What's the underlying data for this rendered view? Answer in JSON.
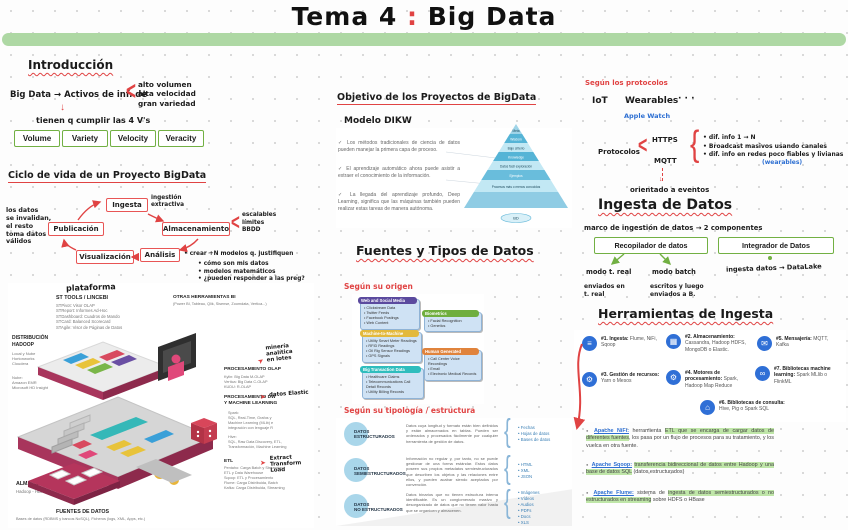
{
  "title": {
    "left": "Tema 4",
    "colon": ":",
    "right": "Big Data"
  },
  "icons": {
    "angle": "<",
    "curly": "{",
    "arrow_down": "↓",
    "check": "✓",
    "hand_arrow": "➤",
    "dot": "●"
  },
  "intro": {
    "heading": "Introducción",
    "definition": "Big Data → Activos de inf. de",
    "brace_items": "alto volumen\nalta velocidad\ngran variedad",
    "subline": "tienen q cumplir las 4 V's",
    "vs": [
      "Volume",
      "Variety",
      "Velocity",
      "Veracity"
    ]
  },
  "ciclo": {
    "heading": "Ciclo de vida de un Proyecto BigData",
    "left_note": "los datos\nse invalidan,\nel resto\ntoma datos\nválidos",
    "ingesta": "Ingesta",
    "ingesta_note": "ingestión\nextractiva",
    "almacenamiento": "Almacenamiento",
    "almacenamiento_notes": "escalables\nlímites\nBBDD",
    "analisis": "Análisis",
    "analisis_note": "• crear +N modelos q. justifiquen",
    "analisis_bullets": "• cómo son mis datos\n• modelos matemáticos\n• ¿pueden responder a las preg?",
    "visualizacion": "Visualización",
    "publicacion": "Publicación"
  },
  "iso": {
    "handwritten_title": "plataforma",
    "sttools_title": "ST TOOLS / LINCEBI",
    "sttools_items": "STPivot: Visor OLAP\nSTReport: Informes Ad-Hoc\nSTDashboard: Cuadros de Mando\nSTCard: Balanced Scorecard\nSTAgile: Visor de Páginas de Datos",
    "otras_title": "OTRAS HERRAMIENTAS BI",
    "otras_items": "(Power BI, Tableau, Qlik, Sisense, Zoomdata, Vertica...)",
    "distrib_title": "DISTRIBUCIÓN\nHADOOP",
    "distrib_local": "Local y Nube\nHortonworks\nCloudera",
    "distrib_nube": "Nube:\nAmazon EMR\nMicrosoft HD Insight",
    "olap_title": "PROCESAMIENTO OLAP",
    "olap_items": "Kylin: Big Data M-OLAP\nVertica: Big Data C-OLAP\nKUDU: R-OLAP",
    "olap_note": "minería analítica\nen lotes",
    "dw_title": "PROCESAMIENTO DW\nY MACHINE LEARNING",
    "dw_note": "datos Elastic",
    "spark": "Spark:\nSQL, Real-Time, Grafos y\nMachine Learning (MLib) e\nintegración con lenguaje R",
    "hive": "Hive:\nSQL, Raw Data Discovery, ETL,\nTransformación, Machine Learning",
    "etl_title": "ETL",
    "etl_items": "Pentaho: Carga Batch y Streaming,\nETL y Data Warehouse\nSqoop: ETL y Procesamiento\nFlume: Carga Distribuida, Batch\nKafka: Carga Distribuida, Streaming",
    "etl_note": "Extract\nTransform\nLoad",
    "alm_title": "ALMACENAMIENTO DISTRIBUIDO",
    "alm_items": "Hadoop - HDFS        Amazon S3",
    "fuentes_title": "FUENTES DE DATOS",
    "fuentes_items": "Bases de datos (RDBMS y bancos NoSQL), Ficheros (logs, XML, Apps, etc.)"
  },
  "objetivo": {
    "heading": "Objetivo de los Proyectos de BigData",
    "modelo": "Modelo DIKW",
    "bullets": [
      "Los métodos tradicionales de ciencia de datos pueden manejar la primera capa de proceso.",
      "El aprendizaje automático ahora puede asistir a extraer el conocimiento de la información.",
      "La llegada del aprendizaje profundo, Deep Learning, significa que las máquinas también pueden realizar estas tareas de manera autónoma."
    ]
  },
  "chart_data": {
    "type": "pyramid",
    "title": "Modelo DIKW",
    "layers_top_to_bottom": [
      "Meta",
      "Wisdom",
      "Bajo criterio",
      "Knowledge",
      "Datos fácil exploración",
      "Ejemplos",
      "Procesos más o menos conocidos",
      ""
    ],
    "base_label": "BD",
    "legend_position": "none",
    "grid": false
  },
  "fuentes": {
    "heading": "Fuentes y Tipos de Datos",
    "origen_label": "Según su origen",
    "boxes": [
      {
        "title": "Web and Social Media",
        "color": "#5b4a9e",
        "items": "• Clickstream Data\n• Twitter Feeds\n• Facebook Postings\n• Web Content"
      },
      {
        "title": "Machine-to-Machine",
        "color": "#e3b93c",
        "items": "• Utility Smart Meter Readings\n• RFID Readings\n• Oil Rig Sensor Readings\n• GPS Signals"
      },
      {
        "title": "Big Transaction Data",
        "color": "#2fbdbd",
        "items": "• Healthcare Claims\n• Telecommunications Call Detail Records\n• Utility Billing Records"
      },
      {
        "title": "Biometrics",
        "color": "#6fae3e",
        "items": "• Facial Recognition\n• Genetics"
      },
      {
        "title": "Human Generated",
        "color": "#e0833c",
        "items": "• Call Center Voice Recordings\n• Email\n• Electronic Medical Records"
      }
    ],
    "tipologia_label": "Según su tipología / estructura",
    "tipos": [
      {
        "label": "DATOS\nESTRUCTURADOS",
        "desc": "Datos cuya longitud y formato están bien definidos y están almacenados en tablas. Pueden ser ordenados y procesados fácilmente por cualquier herramienta de gestión de datos.",
        "examples": "• Fechas\n• Hojas de datos\n• Bases de datos"
      },
      {
        "label": "DATOS\nSEMIESTRUCTURADOS",
        "desc": "Información no regular y, por tanto, no se puede gestionar de una forma estándar. Estos datos poseen sus propios metadatos semiestructurados que describen los objetos y las relaciones entre ellos, y pueden acabar siendo aceptados por convención.",
        "examples": "• HTML\n• XML\n• JSON"
      },
      {
        "label": "DATOS\nNO ESTRUCTURADOS",
        "desc": "Datos binarios que no tienen estructura interna identificable. Es un conglomerado masivo y desorganizado de datos que no tienen valor hasta que se organicen y almacenen.",
        "examples": "• Imágenes\n• Vídeos\n• Audios\n• PDFs\n• Docs\n• XLS"
      }
    ]
  },
  "protocolos": {
    "heading": "Según los protocolos",
    "iot": "IoT",
    "wearables": "Wearables",
    "dots": "· · ·",
    "apple": "Apple Watch",
    "label": "Protocolos",
    "https": "HTTPS",
    "mqtt": "MQTT",
    "bullets": "• dif. info 1 → N\n• Broadcast masivos usando canales\n• dif. info en redes poco fiables y livianas",
    "wearables_note": "(wearables)",
    "eventos": "orientado a eventos"
  },
  "ingesta": {
    "heading": "Ingesta de Datos",
    "marco": "marco de ingestión de datos → 2 componentes",
    "recopilador": "Recopilador de datos",
    "integrador": "Integrador de Datos",
    "modo_real": "modo t. real",
    "modo_batch": "modo batch",
    "real_note": "enviados en\nt. real",
    "batch_note": "escritos y luego\nenviados a B.",
    "integrador_note": "ingesta datos → DataLake"
  },
  "herr": {
    "heading": "Herramientas de Ingesta",
    "items": [
      {
        "t": "#1. Ingesta:",
        "d": "Flume, NiFi, Sqoop",
        "glyph": "≡"
      },
      {
        "t": "#2. Almacenamiento:",
        "d": "Cassandra, Hadoop HDFS, MongoDB o Elastic.",
        "glyph": "▦"
      },
      {
        "t": "#5. Mensajería:",
        "d": "MQTT, Kafka",
        "glyph": "✉"
      },
      {
        "t": "#3. Gestión de recursos:",
        "d": "Yarn o Mesos",
        "glyph": "⚙"
      },
      {
        "t": "#4. Motores de procesamiento:",
        "d": "Spark, Hadoop Map Reduce",
        "glyph": "⚙"
      },
      {
        "t": "#7. Bibliotecas machine learning:",
        "d": "Spark MLlib o FlinkML",
        "glyph": "∞"
      },
      {
        "t": "#6. Bibliotecas de consulta:",
        "d": "Hive, Pig o Spark SQL",
        "glyph": "⌂"
      }
    ],
    "apache": [
      {
        "name": "Apache NiFi:",
        "pre": " herramienta ",
        "hl": "ETL que se encarga de cargar datos de diferentes fuentes",
        "post": ", los pasa por un flujo de procesos para su tratamiento, y los vuelca en otra fuente."
      },
      {
        "name": "Apache Sqoop:",
        "pre": " ",
        "hl": "transferencia bidireccional de datos entre Hadoop y una base de datos SQL",
        "post": " (datos estructurados)"
      },
      {
        "name": "Apache Flume:",
        "pre": " sistema de ",
        "hl": "ingesta de datos semiestructurados o no estructurados en streaming",
        "post": " sobre HDFS o HBase"
      }
    ]
  }
}
